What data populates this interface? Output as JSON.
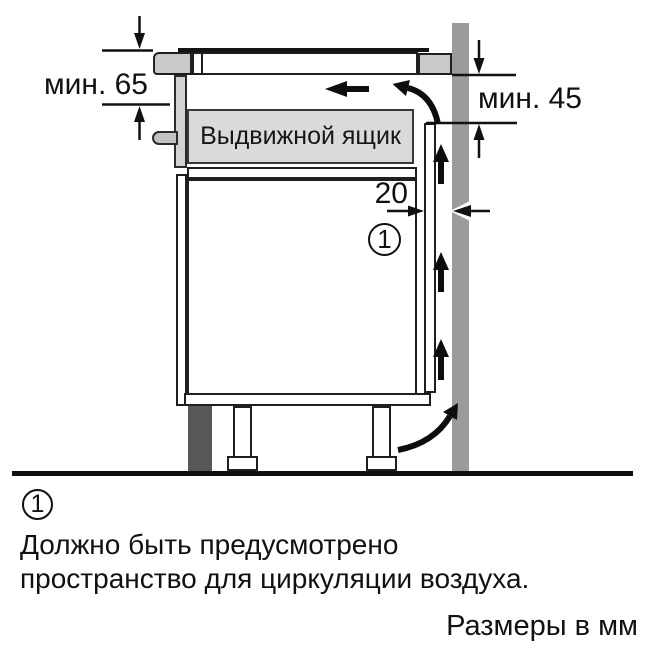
{
  "diagram": {
    "drawer_label": "Выдвижной ящик",
    "dim_top_left": "мин. 65",
    "dim_right": "мин. 45",
    "dim_gap": "20",
    "callout_number": "1",
    "colors": {
      "wall": "#9b9b9b",
      "worktop": "#c9c9c9",
      "drawer_front": "#dadada",
      "front_panel": "#d2d2d2",
      "plinth": "#575757",
      "line": "#111111"
    }
  },
  "footnote": {
    "marker": "1",
    "line1": "Должно быть предусмотрено",
    "line2": "пространство для циркуляции воздуха."
  },
  "units_note": "Размеры в мм"
}
